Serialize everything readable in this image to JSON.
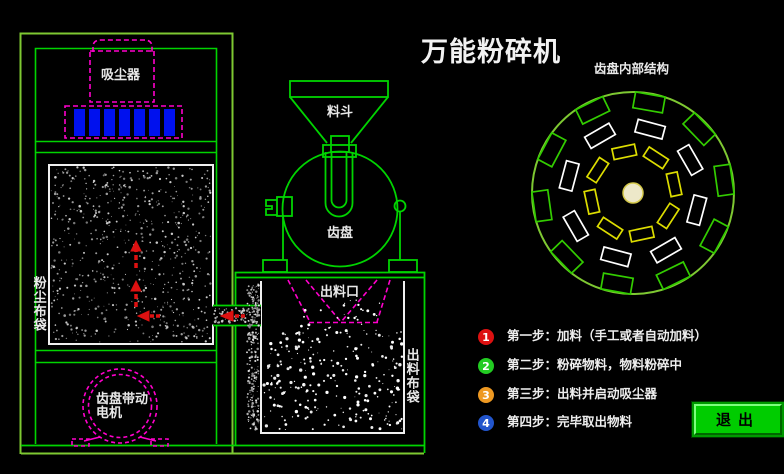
{
  "title": "万能粉碎机",
  "colors": {
    "background": "#000000",
    "frame_green": "#00d400",
    "frame_olive": "#7ec832",
    "dashed_magenta": "#ff00cc",
    "bar_blue": "#0011ee",
    "arrow_red": "#dd1111",
    "white_line": "#f0f0f0",
    "tooth_green": "#33cc00",
    "tooth_white": "#ffffff",
    "tooth_yellow": "#dddd00",
    "disc_center_fill": "#ede8c9",
    "disc_center_stroke": "#d4c84a",
    "button_green": "#00cc00"
  },
  "machine": {
    "dust_collector_label": "吸尘器",
    "dust_bag_label": "粉尘布袋",
    "motor_label_line1": "齿盘带动",
    "motor_label_line2": "电机",
    "hopper_label": "料斗",
    "disc_label": "齿盘",
    "outlet_label": "出料口",
    "outlet_bag_label": "出料布袋"
  },
  "disc_diagram": {
    "title": "齿盘内部结构"
  },
  "steps": [
    {
      "num": "1",
      "color": "#dd1111",
      "text": "第一步：加料（手工或者自动加料）"
    },
    {
      "num": "2",
      "color": "#22cc22",
      "text": "第二步：粉碎物料，物料粉碎中"
    },
    {
      "num": "3",
      "color": "#ee9922",
      "text": "第三步：出料并启动吸尘器"
    },
    {
      "num": "4",
      "color": "#2255cc",
      "text": "第四步：完毕取出物料"
    }
  ],
  "exit_button_label": "退出"
}
